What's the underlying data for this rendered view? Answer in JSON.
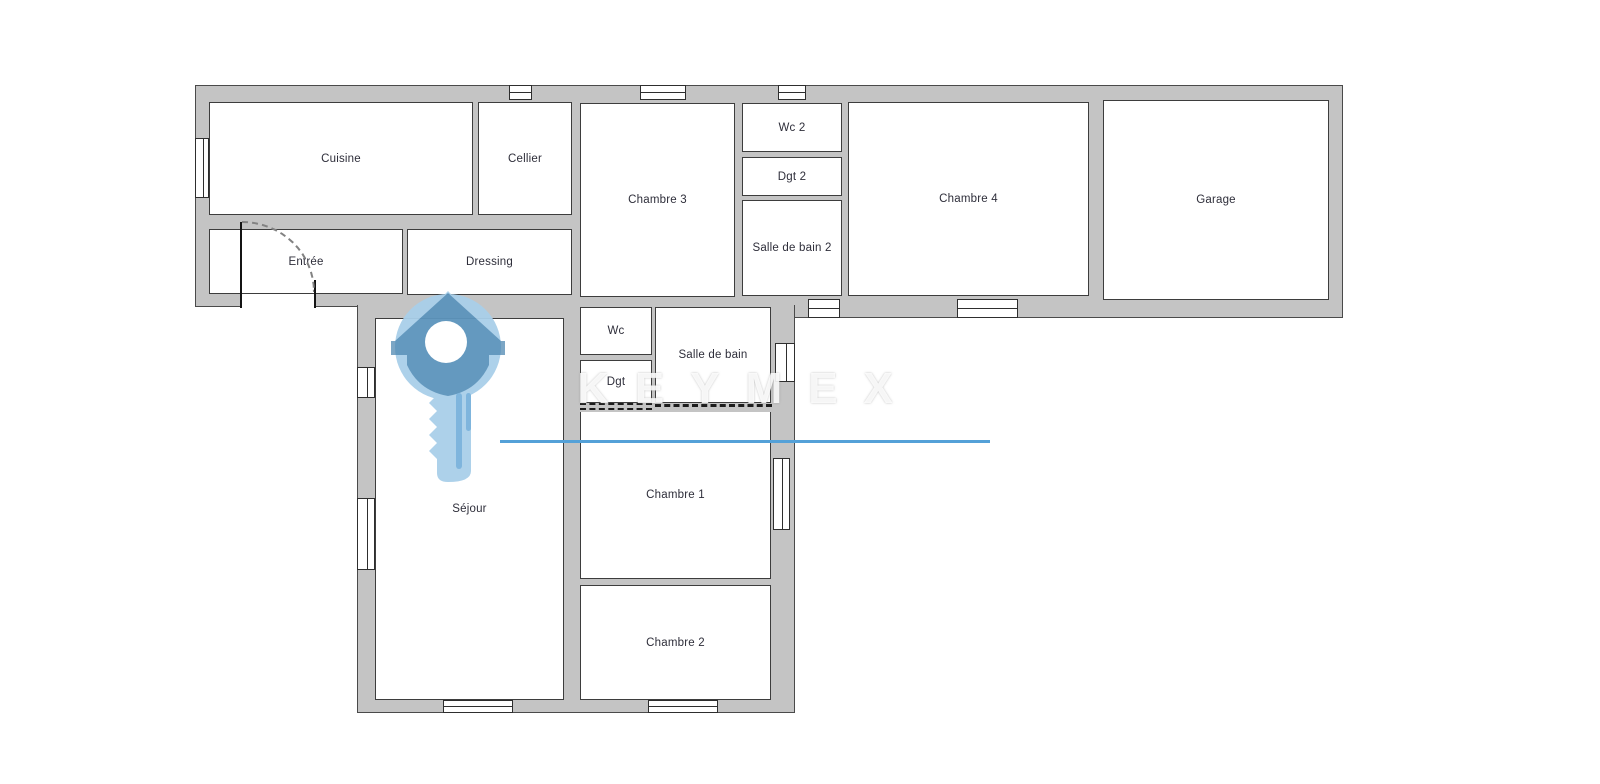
{
  "rooms": {
    "cuisine": {
      "label": "Cuisine"
    },
    "cellier": {
      "label": "Cellier"
    },
    "chambre3": {
      "label": "Chambre 3"
    },
    "wc2": {
      "label": "Wc 2"
    },
    "dgt2": {
      "label": "Dgt 2"
    },
    "salle_de_bain2": {
      "label": "Salle de bain 2"
    },
    "chambre4": {
      "label": "Chambre 4"
    },
    "garage": {
      "label": "Garage"
    },
    "entree": {
      "label": "Entrée"
    },
    "dressing": {
      "label": "Dressing"
    },
    "sejour": {
      "label": "Séjour"
    },
    "wc": {
      "label": "Wc"
    },
    "dgt": {
      "label": "Dgt"
    },
    "salle_de_bain": {
      "label": "Salle de bain"
    },
    "chambre1": {
      "label": "Chambre 1"
    },
    "chambre2": {
      "label": "Chambre 2"
    }
  },
  "watermark": {
    "brand_text": "KEYMEX",
    "underline_color": "#54a1d8",
    "key_light_color": "#a9cfe9",
    "key_dark_color": "#3e7dab"
  },
  "colors": {
    "wall_fill": "#c4c4c4",
    "wall_outline": "#4a4a4a",
    "room_fill": "#ffffff",
    "room_border": "#3d3d3d",
    "label_text": "#2e2e3a"
  }
}
